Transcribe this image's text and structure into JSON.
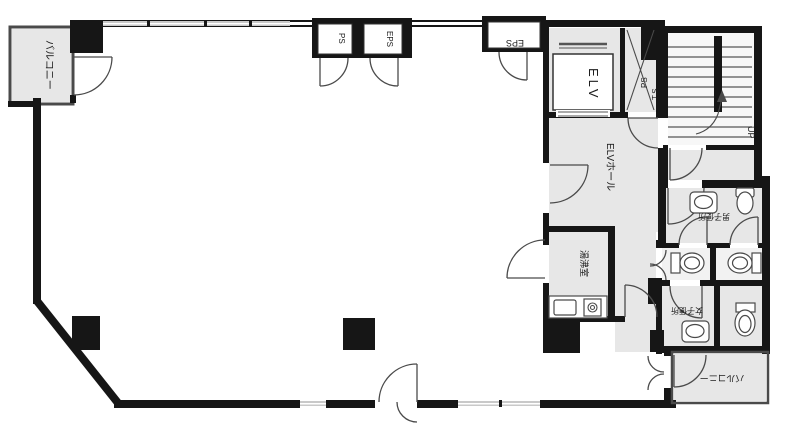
{
  "plan": {
    "labels": {
      "balcony_top_left": "バルコニー",
      "ps_closet": "PS",
      "eps_closet": "EPS",
      "eps_room": "EPS",
      "elevator": "ELV",
      "shaft_ps": "PS",
      "shaft_ts": "T.S",
      "stairs_up": "UP",
      "elv_hall": "ELVホール",
      "kitchenette": "湯沸室",
      "mens_toilet": "男子便所",
      "womens_toilet": "女子便所",
      "balcony_bottom_right": "バルコニー"
    },
    "colors": {
      "wall": "#161616",
      "room": "#e7e7e7",
      "window": "#c9c9c9",
      "line": "#4a4a4a"
    }
  }
}
